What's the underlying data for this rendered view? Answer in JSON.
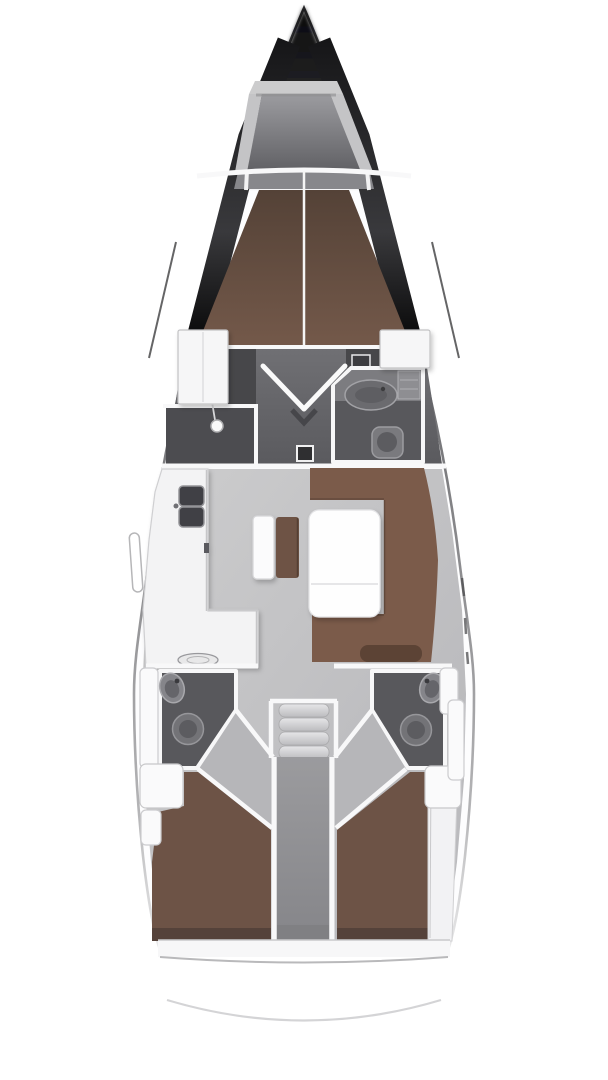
{
  "diagram": {
    "type": "yacht-floor-plan",
    "view": "top-down interior layout",
    "description": "Sailing yacht deck plan: V-berth forward cabin, forward head with shower, saloon with U-settee and table, L-shaped galley, companionway steps, twin aft heads and twin aft double cabins"
  },
  "colors": {
    "page_bg": "#ffffff",
    "hull_fill": "#fdfdfe",
    "bow_dark": "#111113",
    "coachroof_band": "#2c2c2e",
    "anchor_frame": "#cccccd",
    "anchor_floor": "#77777b",
    "shelf_band": "#87878b",
    "wall": "#f8f8f9",
    "forward_berth": "#6f5547",
    "forward_berth_dark": "#52402f",
    "cabin_floor": "#66666a",
    "under_berth_shadow": "#47474a",
    "shower_floor": "#4c4c50",
    "head_floor": "#58585c",
    "counter_gray": "#7c7c80",
    "cabinet_gray": "#8e8e92",
    "fixture_light": "#85858a",
    "fixture_mid": "#737377",
    "fixture_inner": "#5c5c60",
    "sink_dark": "#404044",
    "wardrobe_white": "#f6f6f7",
    "salon_floor": "#c5c5c8",
    "galley_counter": "#f3f3f4",
    "nav_bench": "#fbfbfc",
    "nav_seat_brown": "#6e5345",
    "settee_brown": "#7b5b4a",
    "settee_backrest": "#5c4335",
    "table_white": "#fefefe",
    "wedge_floor": "#b6b6b9",
    "step_light": "#dadadd",
    "corridor_gray": "#909093",
    "aft_berth": "#6d5346",
    "berth_shadow": "#55423a",
    "shelf_white": "#f2f2f4",
    "locker_white": "#fafafb",
    "transom_band": "#f7f7f8",
    "stern_arc": "#d4d4d6",
    "hull_line": "#3a3a3c"
  },
  "rooms": [
    {
      "id": "anchor-locker",
      "label": "anchor locker"
    },
    {
      "id": "forward-cabin",
      "label": "forward V-berth cabin"
    },
    {
      "id": "forward-shower",
      "label": "forward shower stall"
    },
    {
      "id": "forward-head",
      "label": "forward head (WC)"
    },
    {
      "id": "salon",
      "label": "saloon"
    },
    {
      "id": "galley",
      "label": "L-shaped galley"
    },
    {
      "id": "companionway",
      "label": "companionway steps"
    },
    {
      "id": "aft-head-port",
      "label": "aft head port"
    },
    {
      "id": "aft-head-starboard",
      "label": "aft head starboard"
    },
    {
      "id": "aft-cabin-port",
      "label": "aft cabin port"
    },
    {
      "id": "aft-cabin-starboard",
      "label": "aft cabin starboard"
    },
    {
      "id": "engine-compartment",
      "label": "engine compartment corridor"
    },
    {
      "id": "stern-platform",
      "label": "stern swim platform"
    }
  ],
  "fixtures": [
    "galley sinks",
    "stove",
    "chart seat",
    "saloon table",
    "U-settee",
    "wardrobes",
    "shower head",
    "wash basins",
    "toilets",
    "steps"
  ]
}
